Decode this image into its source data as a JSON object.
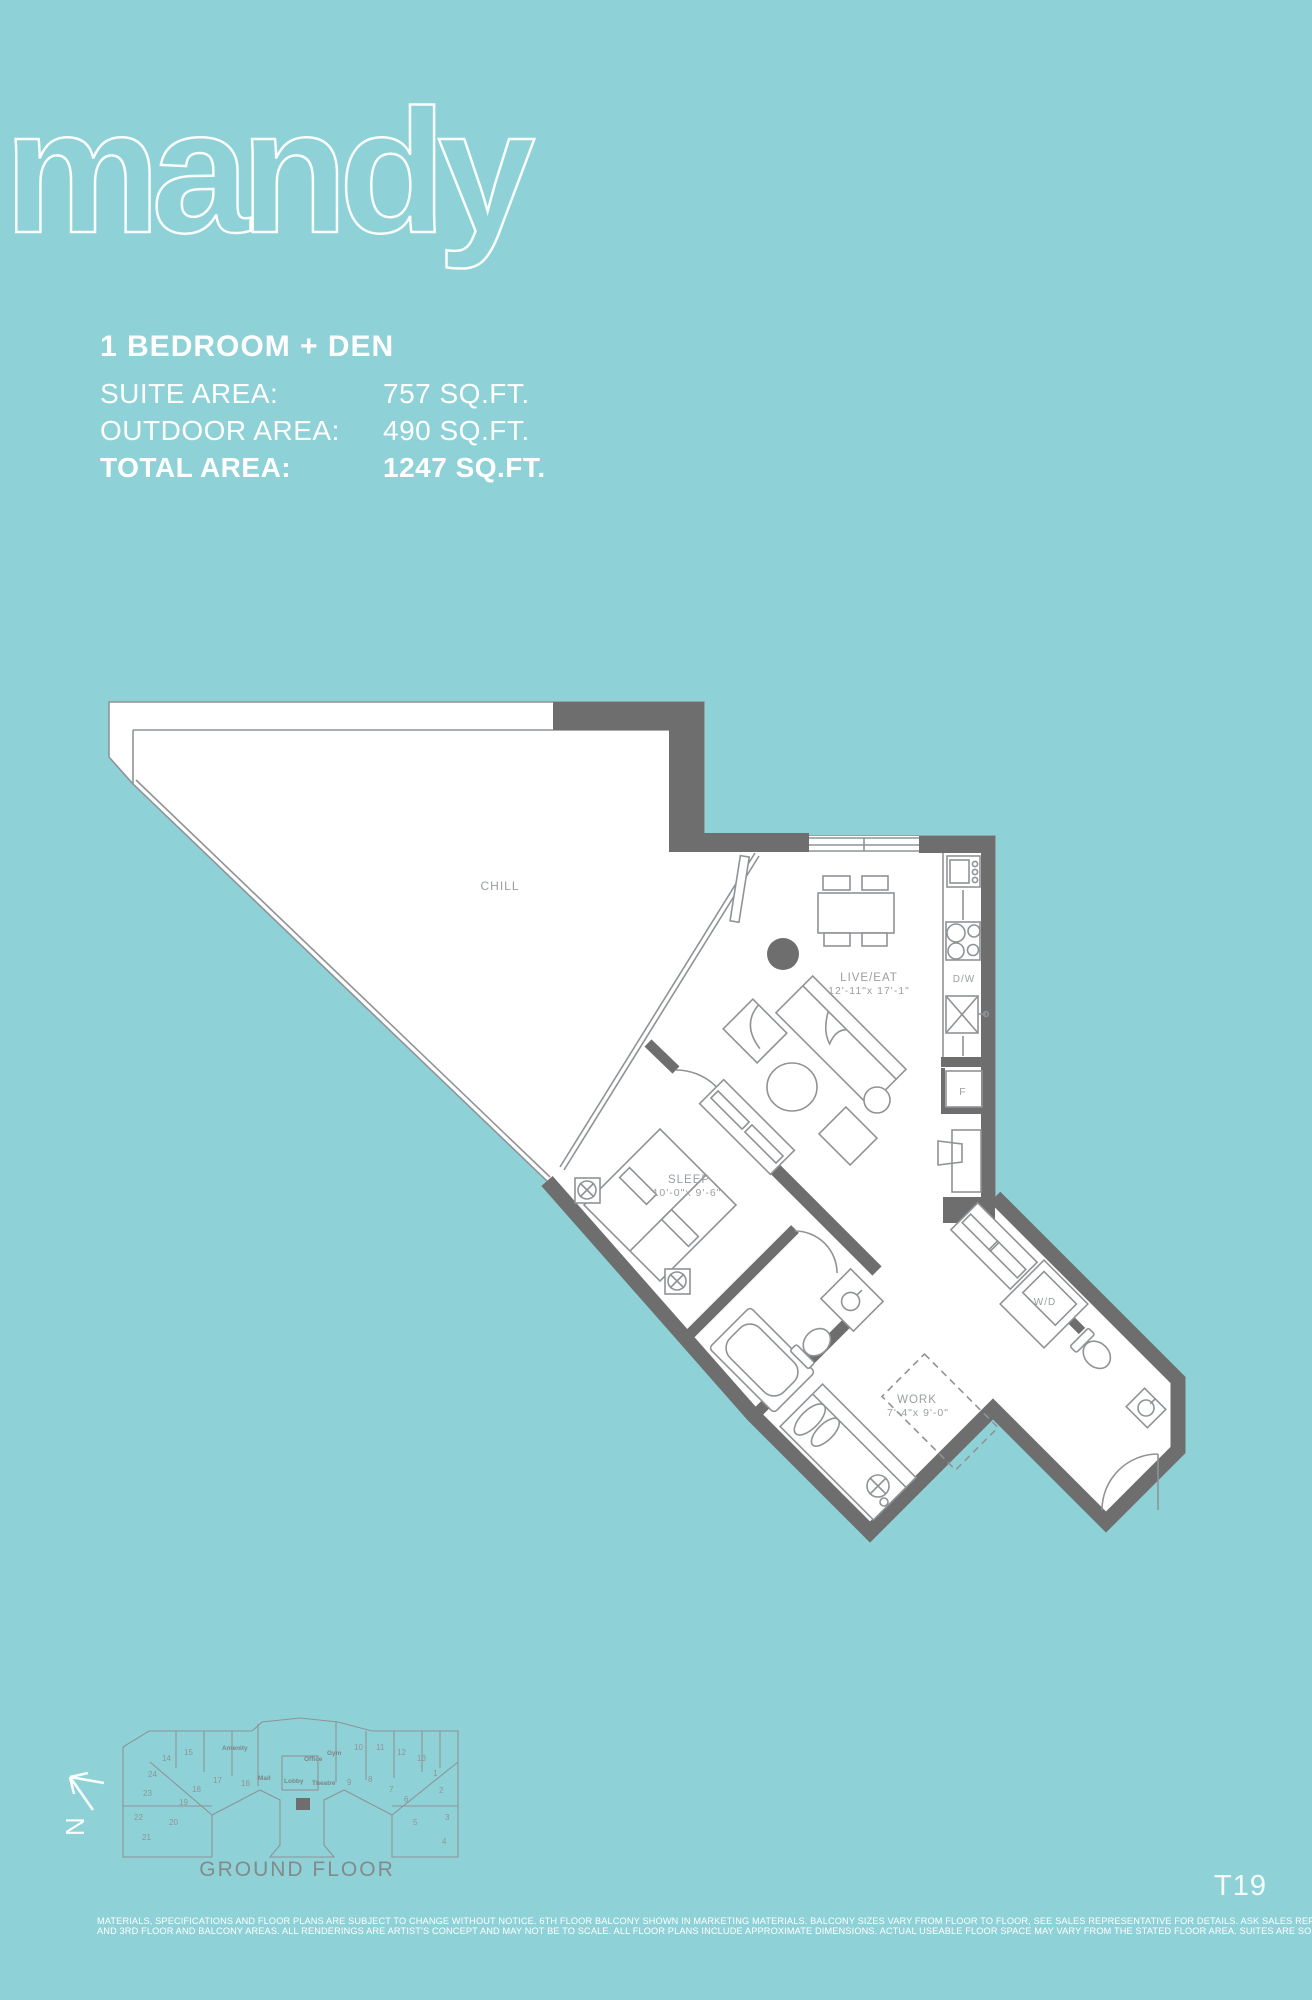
{
  "page": {
    "background_color": "#8ED2D8",
    "wall_color": "#6E6E6E",
    "line_color": "#8F9396",
    "label_color": "#9A9EA0"
  },
  "header": {
    "plan_name": "mandy",
    "unit_type": "1 BEDROOM + DEN",
    "areas": [
      {
        "label": "SUITE AREA:",
        "value": "757 SQ.FT."
      },
      {
        "label": "OUTDOOR AREA:",
        "value": "490 SQ.FT."
      },
      {
        "label": "TOTAL AREA:",
        "value": "1247 SQ.FT."
      }
    ]
  },
  "floor_plan": {
    "terrace_label": "CHILL",
    "live_eat": {
      "name": "LIVE/EAT",
      "dims": "12'-11\"x 17'-1\""
    },
    "sleep": {
      "name": "SLEEP",
      "dims": "10'-0\"x 9'-6\""
    },
    "work": {
      "name": "WORK",
      "dims": "7'-4\"x 9'-0\""
    },
    "appliances": {
      "dishwasher": "D/W",
      "fridge": "F",
      "washer_dryer": "W/D"
    }
  },
  "key_plan": {
    "caption": "GROUND FLOOR",
    "north_label": "N",
    "unit_numbers": [
      "1",
      "2",
      "3",
      "4",
      "5",
      "6",
      "7",
      "8",
      "9",
      "10",
      "11",
      "12",
      "13",
      "14",
      "15",
      "16",
      "17",
      "18",
      "19",
      "20",
      "21",
      "22",
      "23",
      "24"
    ],
    "amenity_labels": [
      "Amenity",
      "Gym",
      "Office",
      "Lobby",
      "Theatre",
      "Mail"
    ]
  },
  "footer": {
    "sheet_code": "T19",
    "disclaimer_line1": "MATERIALS, SPECIFICATIONS AND FLOOR PLANS ARE SUBJECT TO CHANGE WITHOUT NOTICE. 6TH FLOOR BALCONY SHOWN IN MARKETING MATERIALS. BALCONY SIZES VARY FROM FLOOR TO FLOOR, SEE SALES REPRESENTATIVE FOR DETAILS. ASK SALES REP ABOUT 1ST, 2ND",
    "disclaimer_line2": "AND 3RD FLOOR AND BALCONY AREAS. ALL RENDERINGS ARE ARTIST'S CONCEPT AND MAY NOT BE TO SCALE.  ALL FLOOR PLANS INCLUDE APPROXIMATE DIMENSIONS. ACTUAL USEABLE FLOOR SPACE MAY VARY FROM THE STATED FLOOR AREA. SUITES ARE SOLD UNFURNISHED. E. & O.E."
  }
}
